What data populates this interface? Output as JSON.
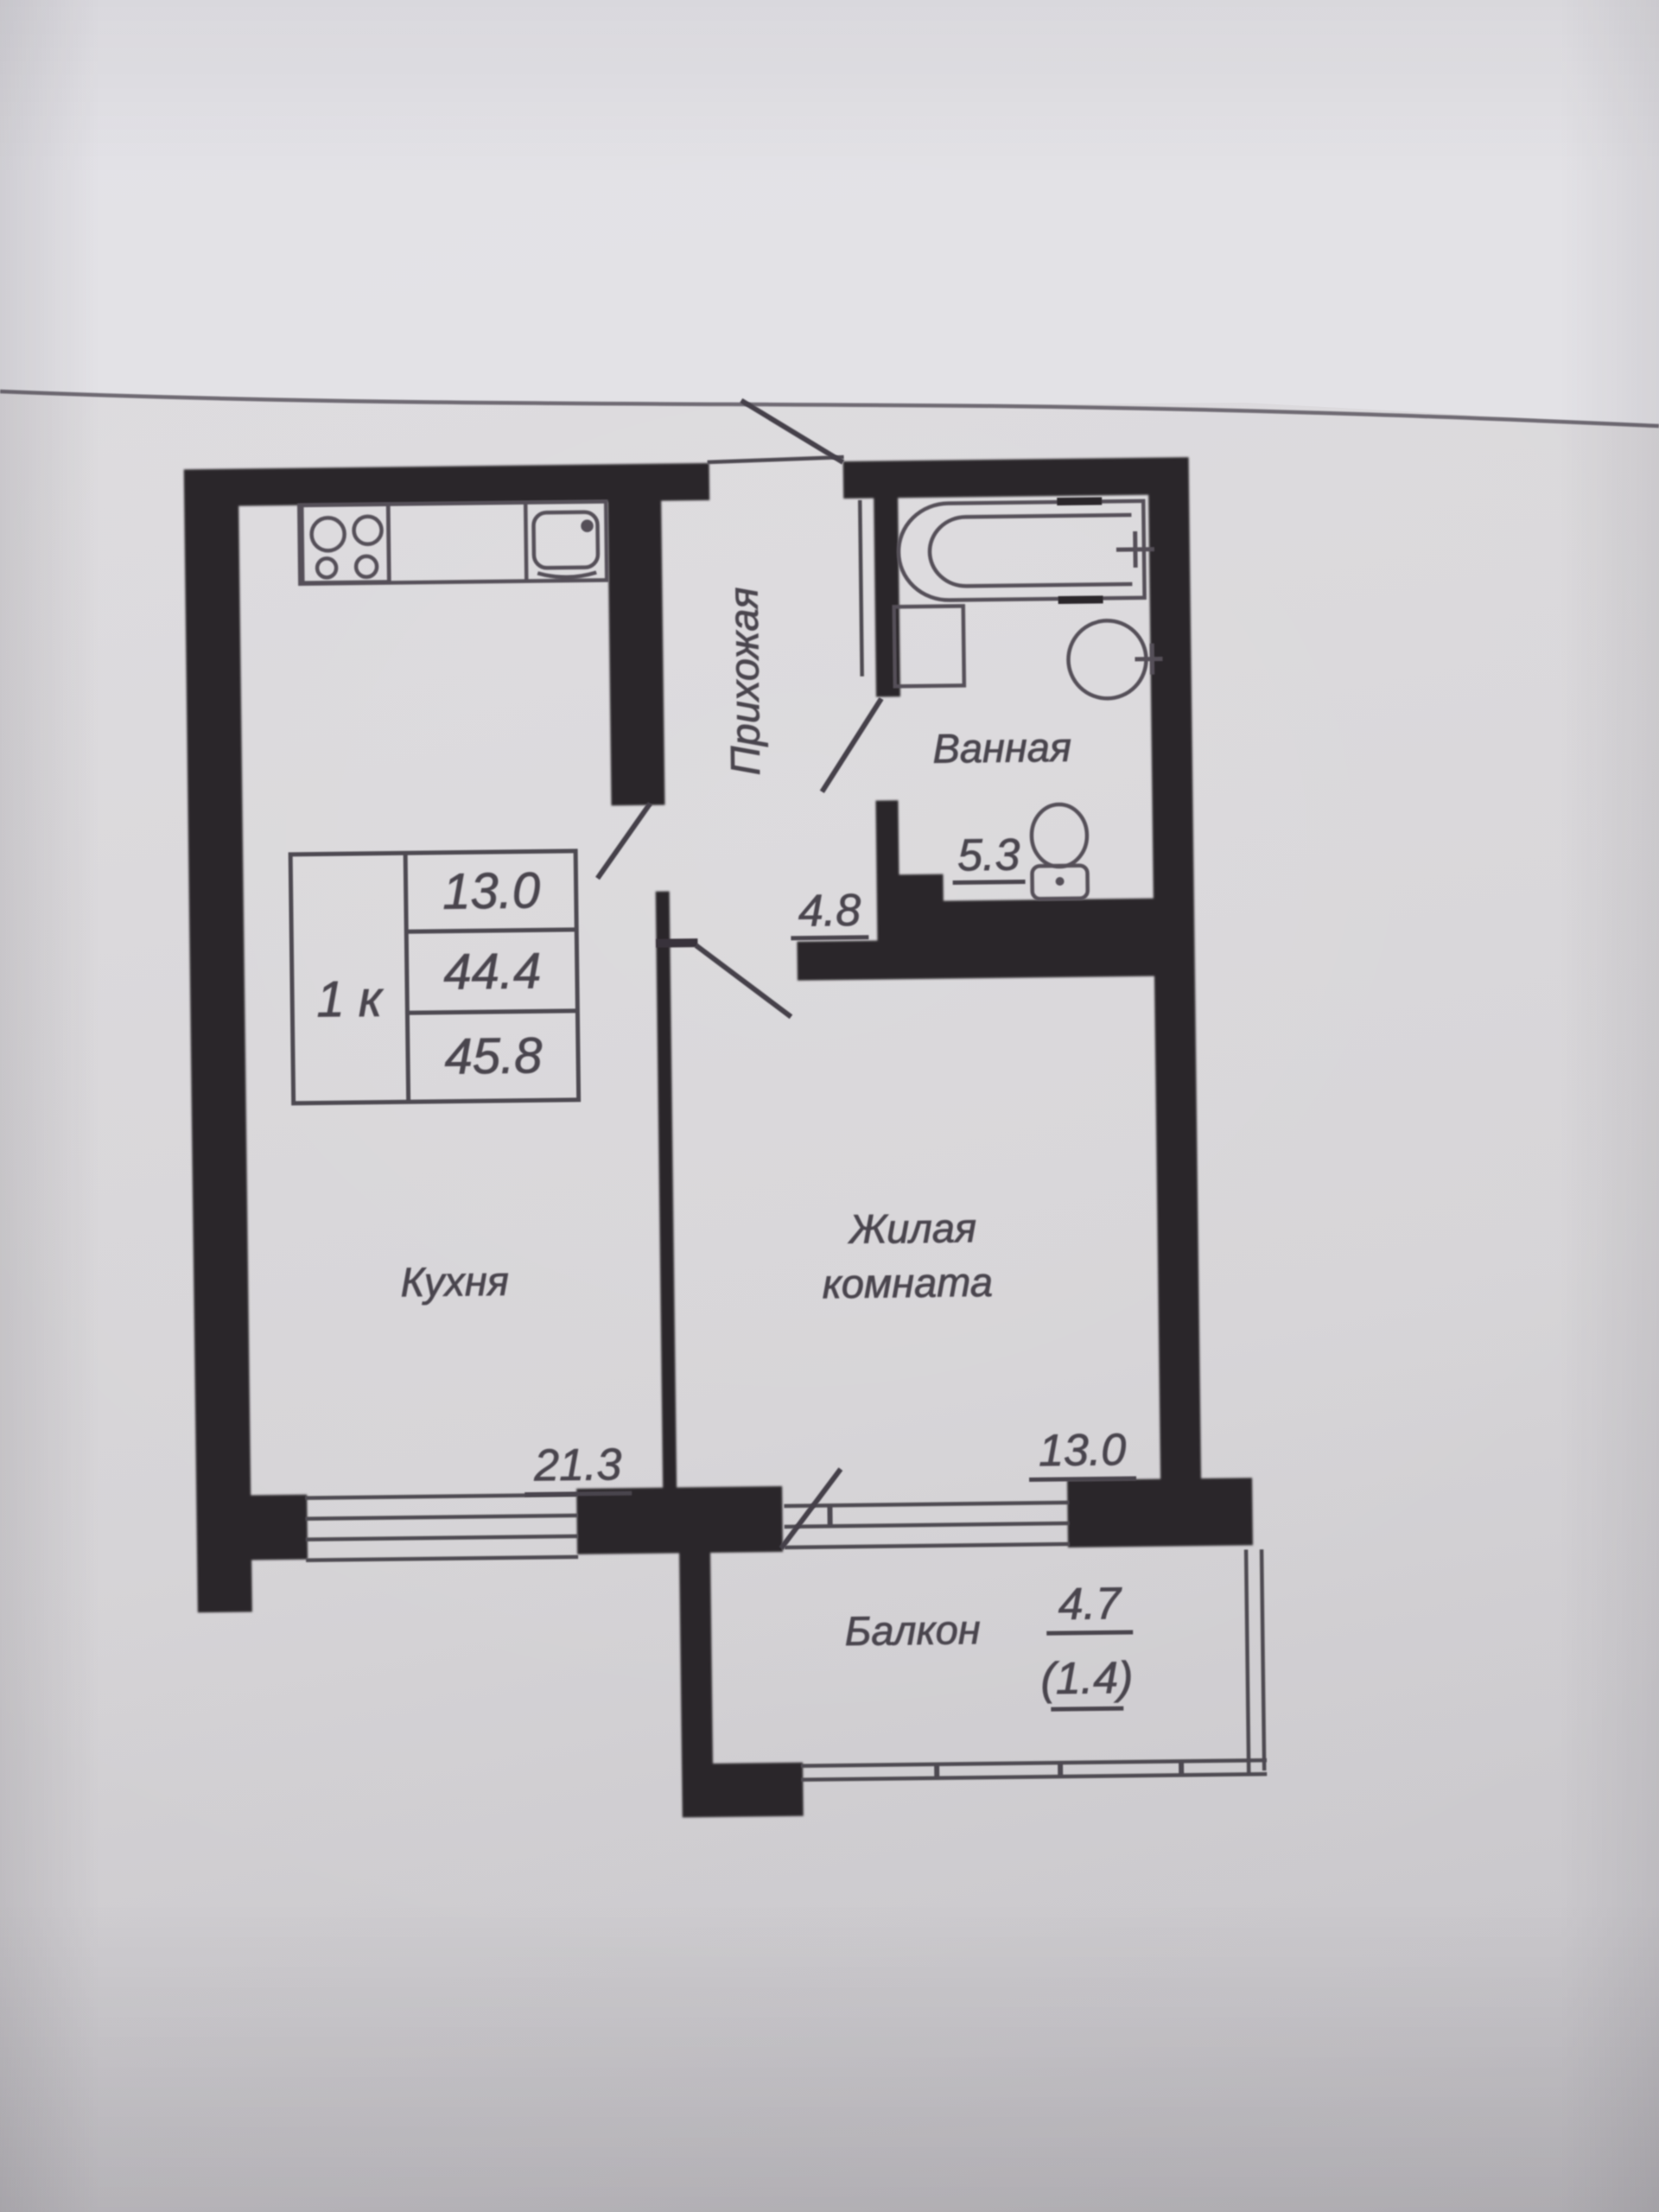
{
  "document": {
    "kind": "apartment floor plan (photographed paper)",
    "language": "ru"
  },
  "info_table": {
    "unit_type": "1 к",
    "living_area": "13.0",
    "area_without_balcony": "44.4",
    "total_area": "45.8"
  },
  "rooms": {
    "hallway": {
      "label": "Прихожая",
      "area": "4.8"
    },
    "bathroom": {
      "label": "Ванная",
      "area": "5.3"
    },
    "kitchen": {
      "label": "Кухня",
      "area": "21.3"
    },
    "living": {
      "label_line1": "Жилая",
      "label_line2": "комната",
      "area": "13.0"
    },
    "balcony": {
      "label": "Балкон",
      "area": "4.7",
      "area_secondary": "(1.4)"
    }
  },
  "fixtures": [
    "stove-icon",
    "kitchen-sink-icon",
    "bathtub-icon",
    "washbasin-icon",
    "wall-sink-icon",
    "toilet-icon"
  ],
  "colors": {
    "paper": "#d7d5d8",
    "paper_light": "#e6e5e9",
    "wall": "#2b282b",
    "line": "#4e4a51",
    "text": "#49454e"
  }
}
